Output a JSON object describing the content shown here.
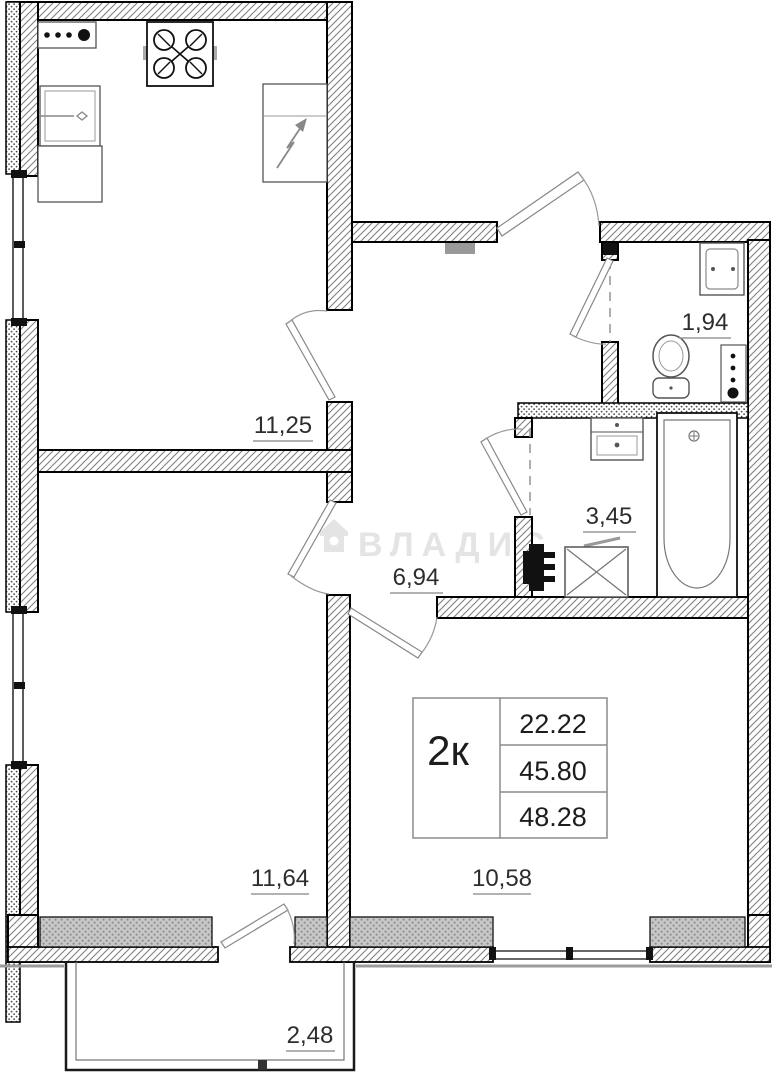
{
  "plan": {
    "title": "2-room apartment floor plan",
    "rooms": {
      "kitchen": {
        "area": "11,25"
      },
      "wc": {
        "area": "1,94"
      },
      "bathroom": {
        "area": "3,45"
      },
      "hall": {
        "area": "6,94"
      },
      "bedroom": {
        "area": "11,64"
      },
      "living": {
        "area": "10,58"
      },
      "balcony": {
        "area": "2,48"
      }
    },
    "info_table": {
      "type_label": "2к",
      "rows": [
        "22.22",
        "45.80",
        "48.28"
      ]
    },
    "watermark": {
      "text": "ВЛАДИС"
    },
    "colors": {
      "wall_outline": "#000000",
      "hatch_line": "#808080",
      "sill_fill": "#c8c8c8",
      "watermark": "#e4e4e4",
      "label_text": "#2d2d2d"
    }
  }
}
